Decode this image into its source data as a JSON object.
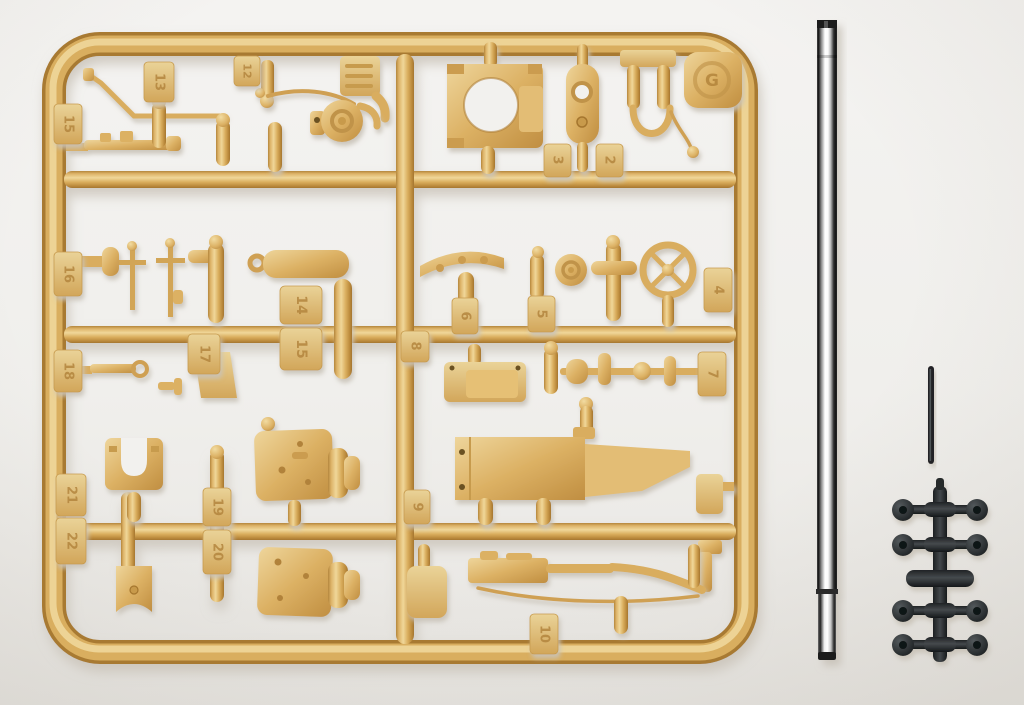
{
  "scene": {
    "subject": "model kit sprue photo",
    "background_color": "#f2f1ee"
  },
  "colors": {
    "tan_plastic": "#dcb164",
    "tan_highlight": "#f0d799",
    "tan_shadow": "#a5762f",
    "metal_dark": "#141414",
    "metal_highlight": "#ffffff",
    "black_plastic": "#26292b",
    "soft_shadow": "#ccc6bc"
  },
  "sprue": {
    "emblem_letter": "G",
    "tags": {
      "tag13": "13",
      "tag12": "12",
      "tag15a": "15",
      "tag3": "3",
      "tag2": "2",
      "tag16": "16",
      "tag14": "14",
      "tag15b": "15",
      "tag8": "8",
      "tag6": "6",
      "tag5": "5",
      "tag4": "4",
      "tag18": "18",
      "tag17": "17",
      "tag7": "7",
      "tag21": "21",
      "tag22": "22",
      "tag19": "19",
      "tag20": "20",
      "tag9": "9",
      "tag10": "10"
    }
  },
  "poly_sprue": {
    "cap_rows": 4,
    "caps_per_row": 2,
    "center_bar_rows": 1
  }
}
